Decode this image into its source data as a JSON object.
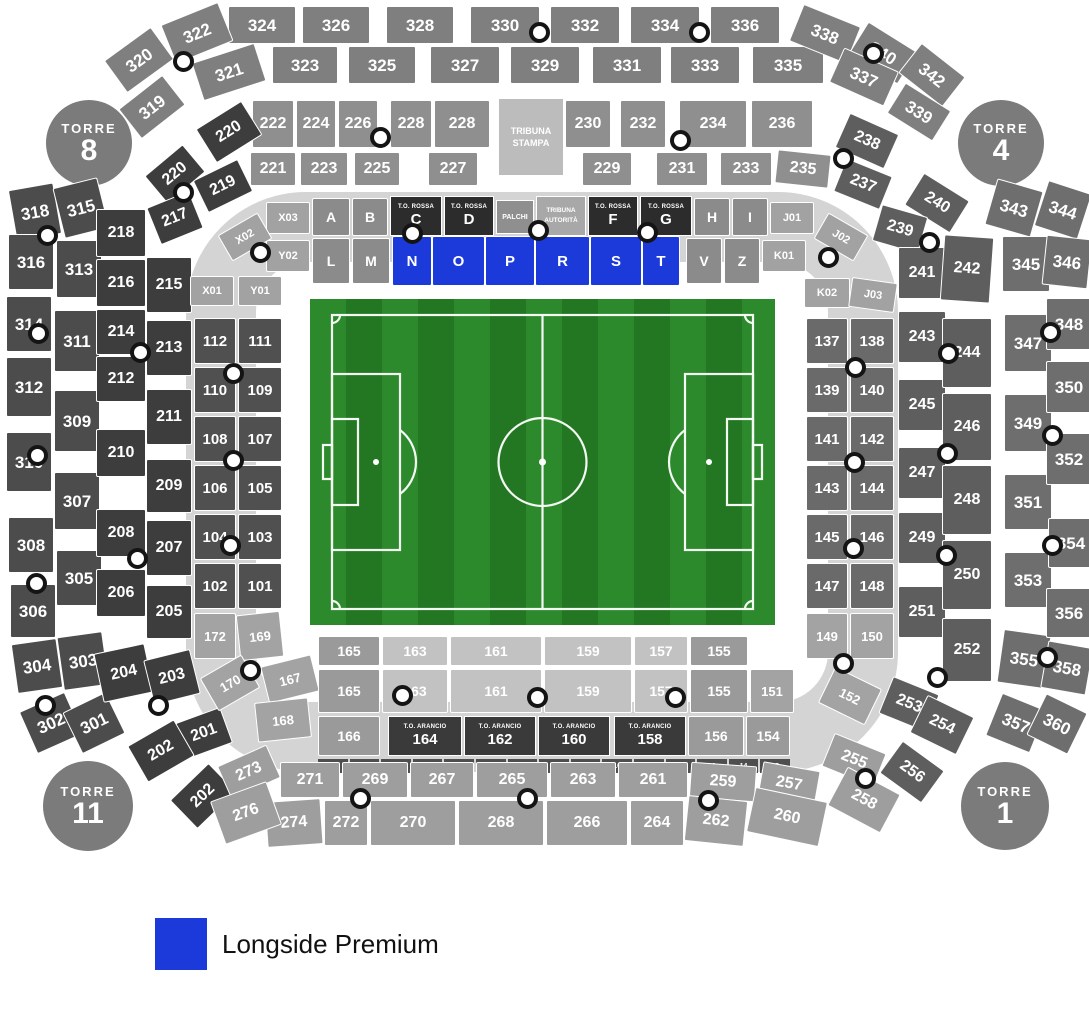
{
  "legend": {
    "label": "Longside Premium",
    "color": "#1c39da"
  },
  "towers": [
    {
      "label": "TORRE",
      "number": "8"
    },
    {
      "label": "TORRE",
      "number": "4"
    },
    {
      "label": "TORRE",
      "number": "11"
    },
    {
      "label": "TORRE",
      "number": "1"
    }
  ],
  "special_sections": {
    "tribuna_stampa_line1": "TRIBUNA",
    "tribuna_stampa_line2": "STAMPA",
    "palchi": "PALCHI",
    "tribuna_autorita_line1": "TRIBUNA",
    "tribuna_autorita_line2": "AUTORITÀ",
    "to_rossa": "T.O. ROSSA",
    "to_arancio": "T.O. ARANCIO"
  },
  "premium_sections": [
    "N",
    "O",
    "P",
    "R",
    "S",
    "T"
  ],
  "rings": {
    "outer_top_row1": [
      "324",
      "326",
      "328",
      "330",
      "332",
      "334",
      "336"
    ],
    "outer_top_row2": [
      "323",
      "325",
      "327",
      "329",
      "331",
      "333",
      "335"
    ],
    "outer_top_left": [
      "320",
      "322",
      "319",
      "321"
    ],
    "outer_top_right": [
      "338",
      "340",
      "337",
      "342",
      "339"
    ],
    "outer_left_outer": [
      "318",
      "316",
      "314",
      "312",
      "310",
      "308",
      "306",
      "304",
      "302"
    ],
    "outer_left_inner": [
      "315",
      "313",
      "311",
      "309",
      "307",
      "305",
      "303",
      "301"
    ],
    "outer_right_inner": [
      "343",
      "345",
      "347",
      "349",
      "351",
      "353",
      "355",
      "357"
    ],
    "outer_right_outer": [
      "344",
      "346",
      "348",
      "350",
      "352",
      "354",
      "356",
      "358",
      "360"
    ],
    "ring2_top_row1_left": [
      "222",
      "224",
      "226",
      "228",
      "228"
    ],
    "ring2_top_row1_right": [
      "230",
      "232",
      "234",
      "236"
    ],
    "ring2_top_row2_left": [
      "221",
      "223",
      "225",
      "227"
    ],
    "ring2_top_row2_right": [
      "229",
      "231",
      "233",
      "235"
    ],
    "ring2_topleft_curve": [
      "220",
      "219",
      "220"
    ],
    "ring2_topright_curve": [
      "238",
      "237",
      "240",
      "239"
    ],
    "ring2_left_outer": [
      "218",
      "216",
      "214",
      "212",
      "210",
      "208",
      "206",
      "204"
    ],
    "ring2_left_inner": [
      "217",
      "215",
      "213",
      "211",
      "209",
      "207",
      "205",
      "203"
    ],
    "ring2_left_bottom": [
      "201",
      "202",
      "202"
    ],
    "ring2_right_inner": [
      "241",
      "243",
      "245",
      "247",
      "249",
      "251",
      "253"
    ],
    "ring2_right_outer": [
      "242",
      "244",
      "246",
      "248",
      "250",
      "252"
    ],
    "ring2_right_bottom": [
      "254",
      "256"
    ],
    "ring2_bottom_row1": [
      "271",
      "269",
      "267",
      "265",
      "263",
      "261",
      "259",
      "257",
      "255"
    ],
    "ring2_bottom_row2": [
      "274",
      "272",
      "270",
      "268",
      "266",
      "264",
      "262",
      "260",
      "258"
    ],
    "ring2_bottom_left": [
      "273",
      "276"
    ],
    "inner_top_row1": [
      "X03",
      "A",
      "B",
      "H",
      "I",
      "J01"
    ],
    "tor_letters": [
      "C",
      "D",
      "F",
      "G"
    ],
    "inner_top_row2": [
      "Y02",
      "L",
      "M",
      "N",
      "O",
      "P",
      "R",
      "S",
      "T",
      "V",
      "Z",
      "K01"
    ],
    "inner_left_curve": [
      "X02",
      "X01",
      "Y01"
    ],
    "inner_right_curve": [
      "J02",
      "K02",
      "J03"
    ],
    "inner_left_pairs": [
      "112",
      "111",
      "110",
      "109",
      "108",
      "107",
      "106",
      "105",
      "104",
      "103",
      "102",
      "101"
    ],
    "inner_right_pairs": [
      "137",
      "138",
      "139",
      "140",
      "141",
      "142",
      "143",
      "144",
      "145",
      "146",
      "147",
      "148"
    ],
    "inner_bottom_left": [
      "172",
      "169",
      "170",
      "167",
      "168"
    ],
    "inner_bottom_right": [
      "149",
      "150",
      "152"
    ],
    "bottom_row1": [
      "165",
      "163",
      "161",
      "159",
      "157",
      "155"
    ],
    "bottom_row2": [
      "165",
      "163",
      "161",
      "159",
      "157",
      "155",
      "151"
    ],
    "bottom_row3_left": [
      "166"
    ],
    "toa_numbers": [
      "164",
      "162",
      "160",
      "158"
    ],
    "bottom_row3_right": [
      "156",
      "154"
    ],
    "gate_numbers": [
      "1",
      "2",
      "3",
      "4",
      "5",
      "6",
      "7",
      "8",
      "9",
      "10",
      "11",
      "12",
      "13",
      "14",
      "15"
    ]
  }
}
